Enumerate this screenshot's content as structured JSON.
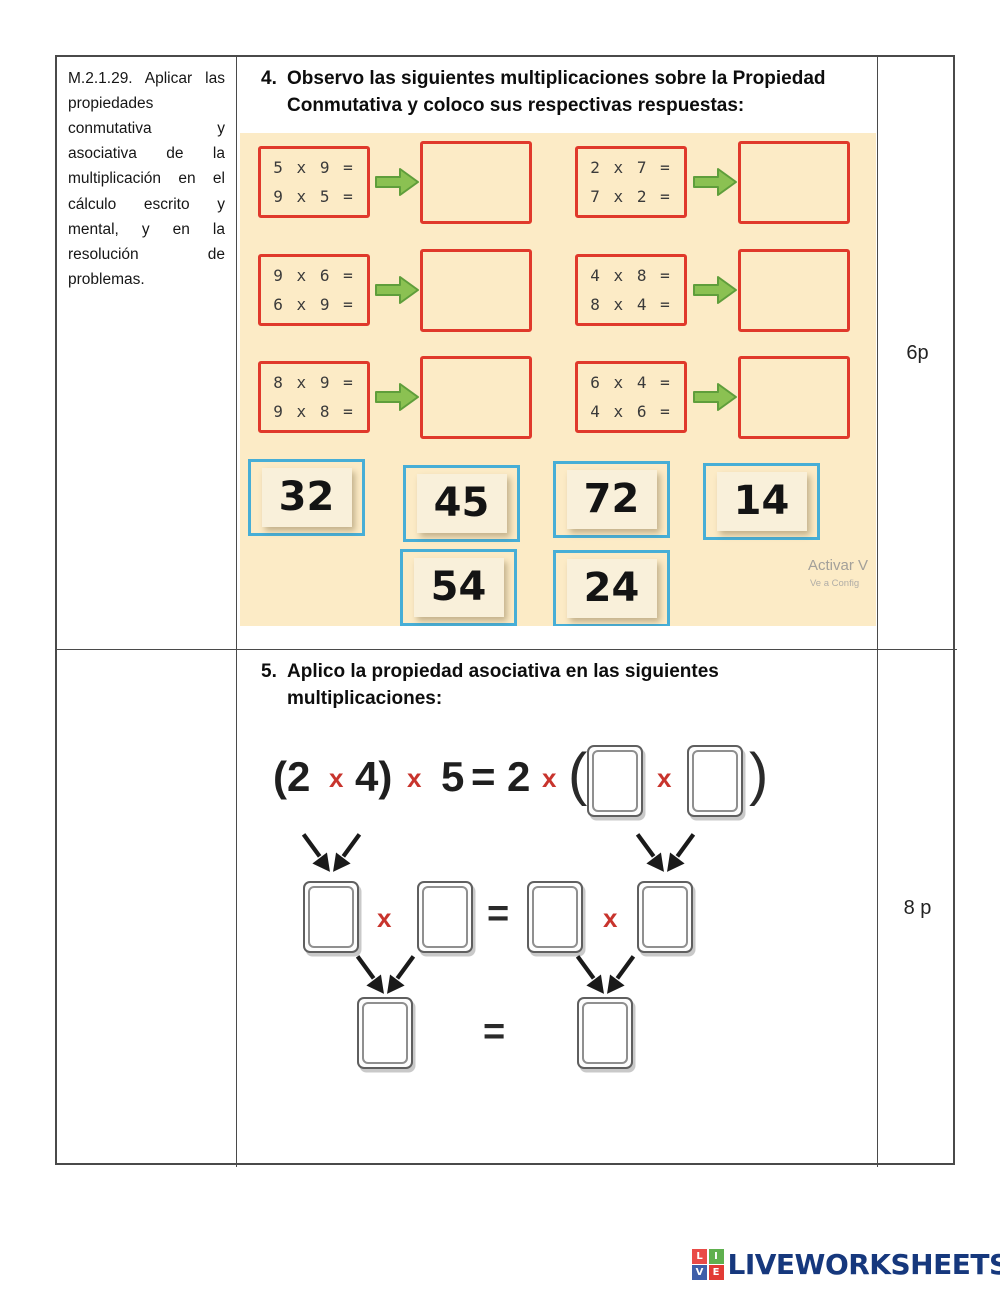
{
  "objective": "M.2.1.29. Aplicar las propiedades conmutativa y asociativa de la multiplicación en el cálculo escrito y mental, y en la resolución de problemas.",
  "points": {
    "exercise4": "6p",
    "exercise5": "8 p"
  },
  "exercise4": {
    "number": "4.",
    "title": "Observo las siguientes multiplicaciones sobre la Propiedad Conmutativa y coloco sus respectivas respuestas:",
    "groups": [
      {
        "line1": "5 x 9 =",
        "line2": "9 x 5 ="
      },
      {
        "line1": "2 x 7 =",
        "line2": "7 x 2 ="
      },
      {
        "line1": "9 x 6 =",
        "line2": "6 x 9 ="
      },
      {
        "line1": "4 x 8 =",
        "line2": "8 x 4 ="
      },
      {
        "line1": "8 x 9 =",
        "line2": "9 x 8 ="
      },
      {
        "line1": "6 x 4 =",
        "line2": "4 x 6 ="
      }
    ],
    "answer_tiles": [
      "32",
      "45",
      "72",
      "14",
      "54",
      "24"
    ],
    "watermark": {
      "line1": "Activar V",
      "line2": "Ve a Config"
    }
  },
  "exercise5": {
    "number": "5.",
    "title": "Aplico la propiedad asociativa en las siguientes multiplicaciones:",
    "equation_tokens": [
      "(2",
      "x",
      "4)",
      "x",
      "5",
      "=",
      "2",
      "x",
      "(",
      "x",
      ")"
    ],
    "middle_row_tokens": [
      "x",
      "=",
      "x"
    ],
    "bottom_row_tokens": [
      "="
    ]
  },
  "footer": {
    "logo_text": "LIVEWORKSHEETS",
    "logo_squares": [
      {
        "letter": "L",
        "color": "#e94b47"
      },
      {
        "letter": "I",
        "color": "#5fb04e"
      },
      {
        "letter": "V",
        "color": "#3f5fa9"
      },
      {
        "letter": "E",
        "color": "#e23b35"
      }
    ]
  },
  "colors": {
    "problem_box_border": "#e0392b",
    "arrow_green": "#8bc152",
    "tile_border": "#47aed6",
    "panel_background": "#fcebc6",
    "red_x": "#c8342d",
    "logo_navy": "#16387d",
    "table_border": "#4a4a4a",
    "watermark_gray": "#a3a09a"
  }
}
